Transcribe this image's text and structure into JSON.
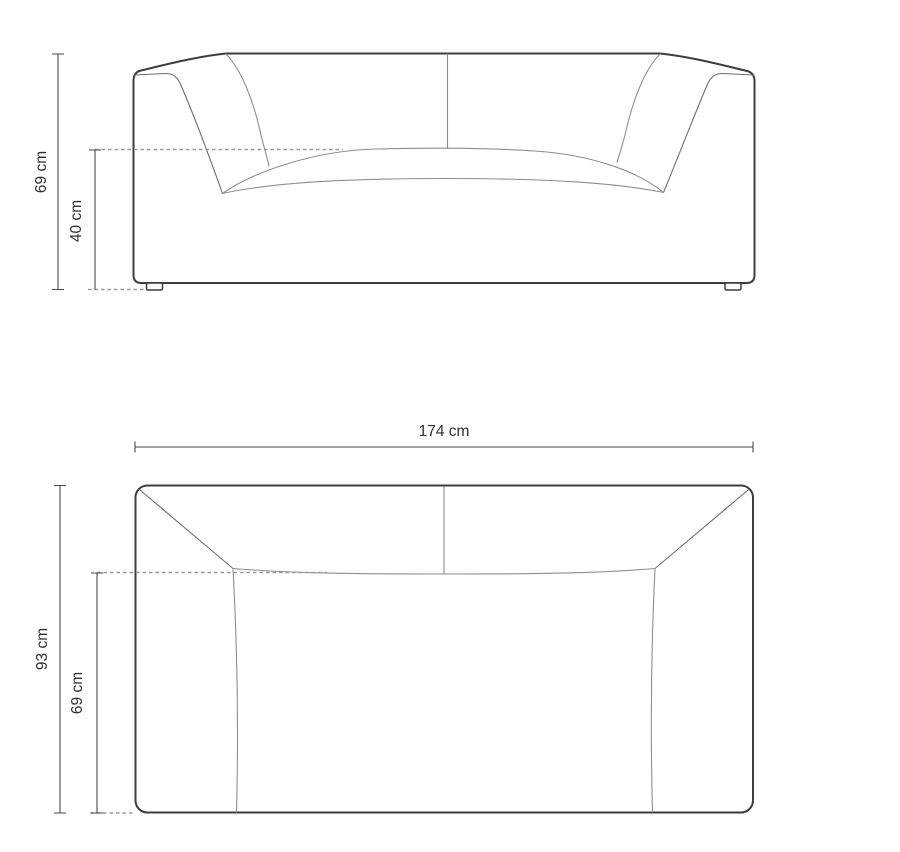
{
  "diagram": {
    "kind": "sofa-dimension-drawing",
    "views": {
      "front": {
        "name": "front-view",
        "dimensions": {
          "overall_height": {
            "label": "69 cm",
            "value": 69,
            "unit": "cm"
          },
          "seat_height": {
            "label": "40 cm",
            "value": 40,
            "unit": "cm"
          }
        }
      },
      "top": {
        "name": "top-view",
        "dimensions": {
          "overall_width": {
            "label": "174 cm",
            "value": 174,
            "unit": "cm"
          },
          "overall_depth": {
            "label": "93 cm",
            "value": 93,
            "unit": "cm"
          },
          "seat_depth": {
            "label": "69 cm",
            "value": 69,
            "unit": "cm"
          }
        }
      }
    },
    "colors": {
      "background": "#ffffff",
      "outline": "#3d3d3d",
      "seam": "#8e8e8e",
      "dimension_line": "#4a4a4a",
      "dashed_line": "#9a9a9a",
      "text": "#2f2f2f"
    }
  }
}
